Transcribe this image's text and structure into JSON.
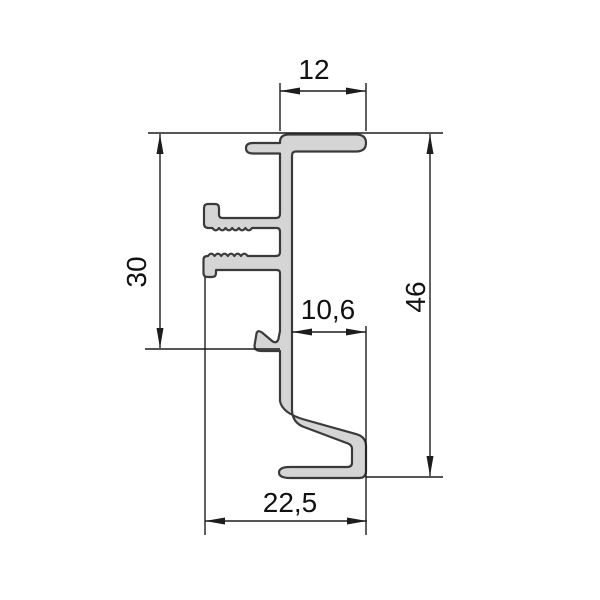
{
  "drawing": {
    "type": "technical-cross-section",
    "subject": "aluminium-extrusion-profile",
    "background": "#ffffff",
    "colors": {
      "profile_fill": "#d5d5d5",
      "profile_outline": "#3a3a3a",
      "dimension_line": "#1d1d1d",
      "label_text": "#111111"
    },
    "dimensions": [
      {
        "id": "top-flange-width",
        "label": "12",
        "orientation": "horizontal",
        "position": "top"
      },
      {
        "id": "left-height",
        "label": "30",
        "orientation": "vertical",
        "position": "left"
      },
      {
        "id": "inner-width",
        "label": "10,6",
        "orientation": "horizontal",
        "position": "middle"
      },
      {
        "id": "overall-height",
        "label": "46",
        "orientation": "vertical",
        "position": "right"
      },
      {
        "id": "bottom-width",
        "label": "22,5",
        "orientation": "horizontal",
        "position": "bottom"
      }
    ]
  }
}
